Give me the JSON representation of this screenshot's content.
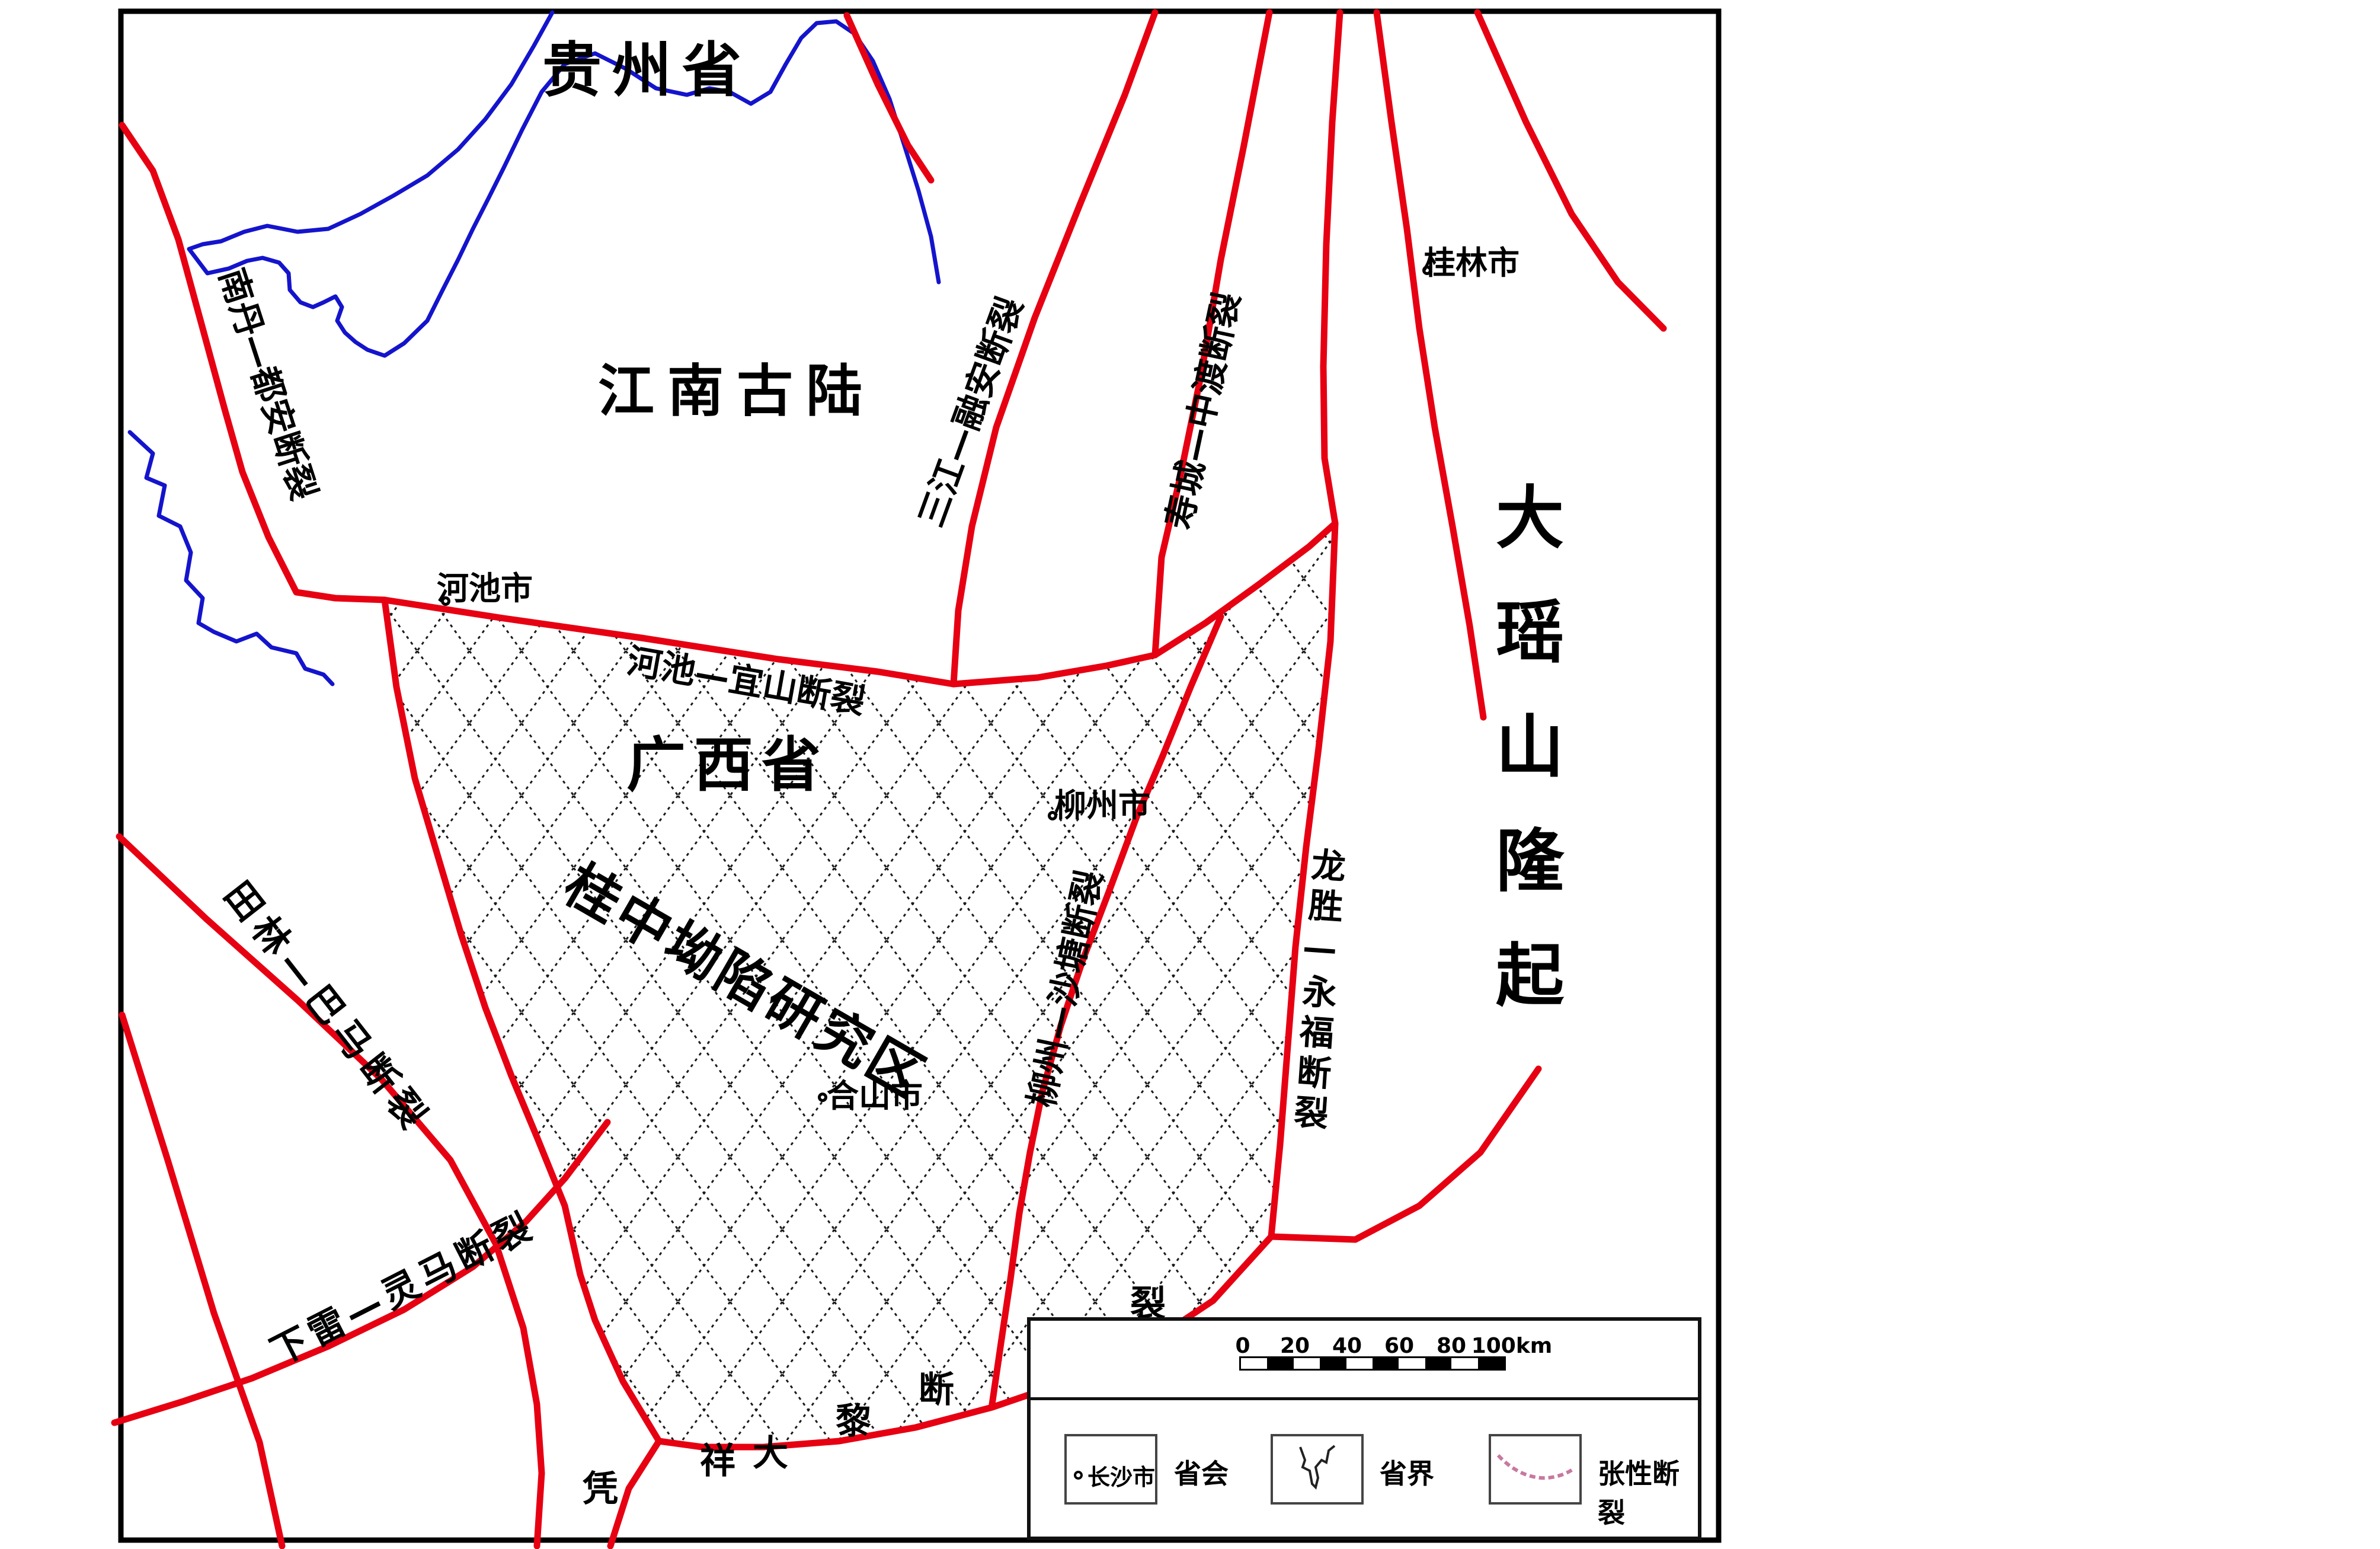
{
  "map": {
    "regions": {
      "guizhou": "贵州省",
      "jiangnan": "江南古陆",
      "guangxi": "广西省",
      "study_area": "桂中坳陷研究区",
      "dayaoshan_uplift": "大瑶山隆起"
    },
    "cities": {
      "hechi": "河池市",
      "liuzhou": "柳州市",
      "heshan": "合山市",
      "guilin": "桂林市"
    },
    "faults": {
      "nandan_duan": "南丹—都安断裂",
      "hechi_yishan": "河池—宜山断裂",
      "sanjiang_rongan": "三江—融安断裂",
      "shoucheng_zhongdu": "寿城—中渡断裂",
      "longsheng_yongfu": "龙胜—永福断裂",
      "liuzhou_shatang": "柳州—沙塘断裂",
      "tianlin_bama": "田林—巴马断裂",
      "xialei_lingma": "下雷—灵马断裂",
      "pingxiang_dali_chars": [
        "凭",
        "祥",
        "大",
        "黎",
        "断",
        "裂"
      ]
    }
  },
  "legend": {
    "scale_ticks": [
      "0",
      "20",
      "40",
      "60",
      "80",
      "100km"
    ],
    "items": {
      "capital_sample": "长沙市",
      "capital_label": "省会",
      "boundary_label": "省界",
      "tension_fault_label": "张性断裂"
    }
  },
  "colors": {
    "fault_red": "#e60012",
    "boundary_blue": "#1414cc",
    "tension_pink": "#c878a0",
    "hatch_black": "#1a1a1a"
  }
}
